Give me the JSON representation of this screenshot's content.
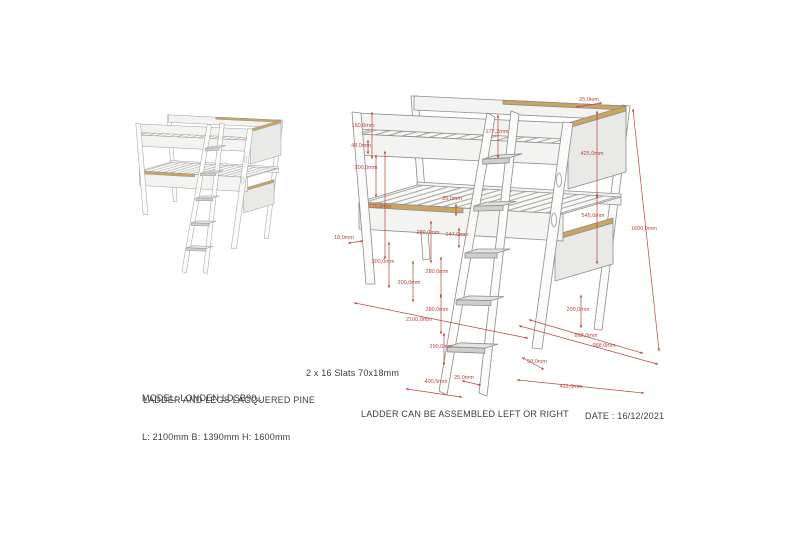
{
  "document": {
    "model": "MODEL: LONDEN LDSB90..",
    "size": "L: 2100mm B: 1390mm H: 1600mm",
    "material": "LADDER AND LEGS LACQUERED PINE",
    "slats": "2 x 16 Slats 70x18mm",
    "assembly": "LADDER CAN BE ASSEMBLED LEFT OR RIGHT",
    "date": "DATE : 16/12/2021"
  },
  "colors": {
    "dimension": "#b5473d",
    "wood": "#cda45f",
    "panel": "#f3f3f2",
    "outline": "#8c8c8c"
  },
  "diagram": {
    "dimension_labels": [
      {
        "text": "160,0mm",
        "x": 363,
        "y": 127
      },
      {
        "text": "48,0mm",
        "x": 361,
        "y": 147
      },
      {
        "text": "200,0mm",
        "x": 366,
        "y": 169
      },
      {
        "text": "770,0mm",
        "x": 380,
        "y": 208
      },
      {
        "text": "18,0mm",
        "x": 344,
        "y": 239
      },
      {
        "text": "300,0mm",
        "x": 383,
        "y": 263
      },
      {
        "text": "200,0mm",
        "x": 409,
        "y": 284
      },
      {
        "text": "177,2mm",
        "x": 497,
        "y": 133
      },
      {
        "text": "25,0mm",
        "x": 452,
        "y": 200
      },
      {
        "text": "280,0mm",
        "x": 428,
        "y": 234
      },
      {
        "text": "147,0mm",
        "x": 457,
        "y": 236
      },
      {
        "text": "280,0mm",
        "x": 437,
        "y": 273
      },
      {
        "text": "280,0mm",
        "x": 437,
        "y": 311
      },
      {
        "text": "2100,0mm",
        "x": 419,
        "y": 321
      },
      {
        "text": "290,0mm",
        "x": 441,
        "y": 348
      },
      {
        "text": "400,5mm",
        "x": 436,
        "y": 383
      },
      {
        "text": "25,0mm",
        "x": 464,
        "y": 379
      },
      {
        "text": "25,0mm",
        "x": 589,
        "y": 101
      },
      {
        "text": "425,0mm",
        "x": 592,
        "y": 155
      },
      {
        "text": "545,0mm",
        "x": 593,
        "y": 217
      },
      {
        "text": "1600,0mm",
        "x": 644,
        "y": 230
      },
      {
        "text": "200,0mm",
        "x": 578,
        "y": 311
      },
      {
        "text": "868,0mm",
        "x": 586,
        "y": 337
      },
      {
        "text": "968,0mm",
        "x": 604,
        "y": 347
      },
      {
        "text": "50,0mm",
        "x": 537,
        "y": 363
      },
      {
        "text": "422,0mm",
        "x": 571,
        "y": 388
      }
    ]
  }
}
